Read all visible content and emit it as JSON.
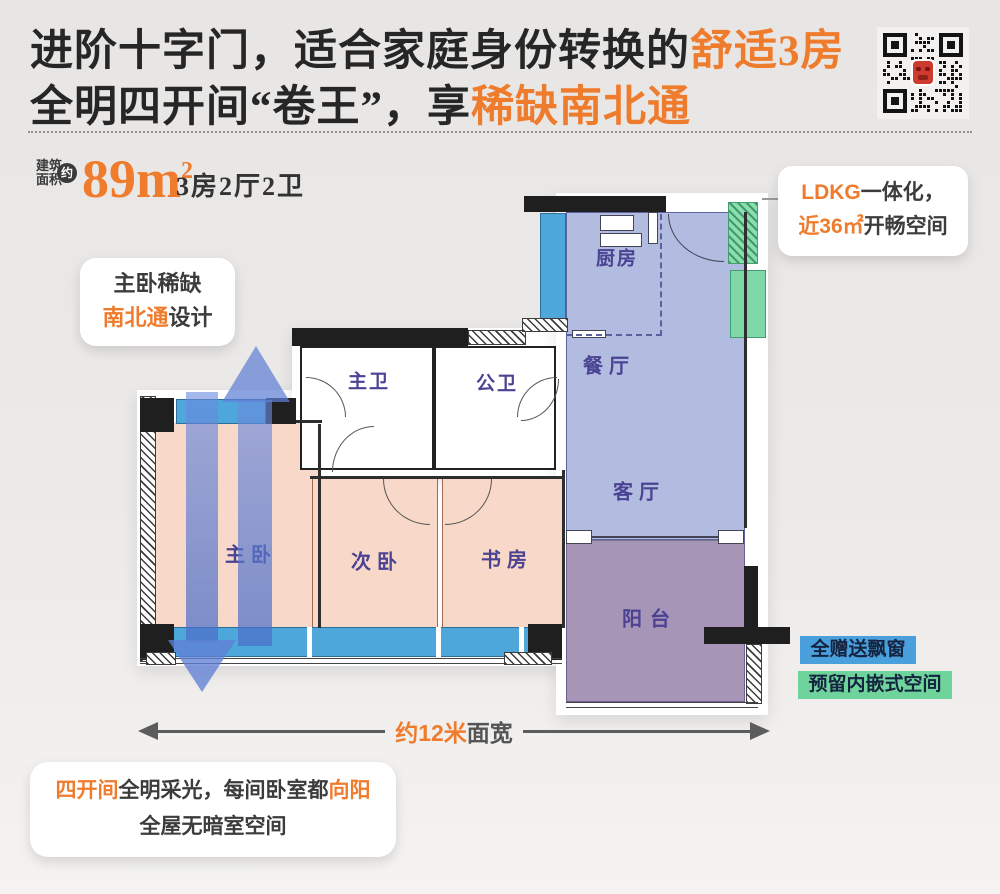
{
  "title": {
    "line1_dark": "进阶十字门，适合家庭身份转换的",
    "line1_accent": "舒适3房",
    "line2_dark": "全明四开间“卷王”，享",
    "line2_accent": "稀缺南北通"
  },
  "area_info": {
    "label_line1": "建筑",
    "label_line2": "面积",
    "approx_badge": "约",
    "value": "89m",
    "value_sup": "2",
    "layout": "3房2厅2卫"
  },
  "plan": {
    "rooms": {
      "master_bedroom": "主卧",
      "second_bedroom": "次卧",
      "study": "书房",
      "master_bath": "主卫",
      "public_bath": "公卫",
      "kitchen": "厨房",
      "dining": "餐厅",
      "living": "客厅",
      "balcony": "阳台"
    }
  },
  "callouts": {
    "master_ns": {
      "line1": "主卧稀缺",
      "line2_accent": "南北通",
      "line2_dark": "设计"
    },
    "ldkg": {
      "line1_accent": "LDKG",
      "line1_dark": "一体化，",
      "line2_accent": "近36㎡",
      "line2_dark": "开畅空间"
    },
    "bay_window": "全赠送飘窗",
    "embedded_space": "预留内嵌式空间",
    "bottom": {
      "line1_accent_a": "四开间",
      "line1_dark": "全明采光，每间卧室都",
      "line1_accent_b": "向阳",
      "line2": "全屋无暗室空间"
    }
  },
  "dimension": {
    "accent": "约12米",
    "dark": "面宽"
  },
  "colors": {
    "accent_orange": "#ef7b2d",
    "title_dark": "#262626",
    "room_pink": "#f8d8c8",
    "ldk_blue": "#b2bbe0",
    "balcony_mauve": "#a695b7",
    "window_blue": "#4da7da",
    "embedded_green": "#7fd8a8",
    "arrow_blue": "#5c7fd0",
    "room_label_purple": "#4a4292",
    "bay_label_blue": "#4aa0dd",
    "embedded_label_green": "#6fd49b"
  }
}
